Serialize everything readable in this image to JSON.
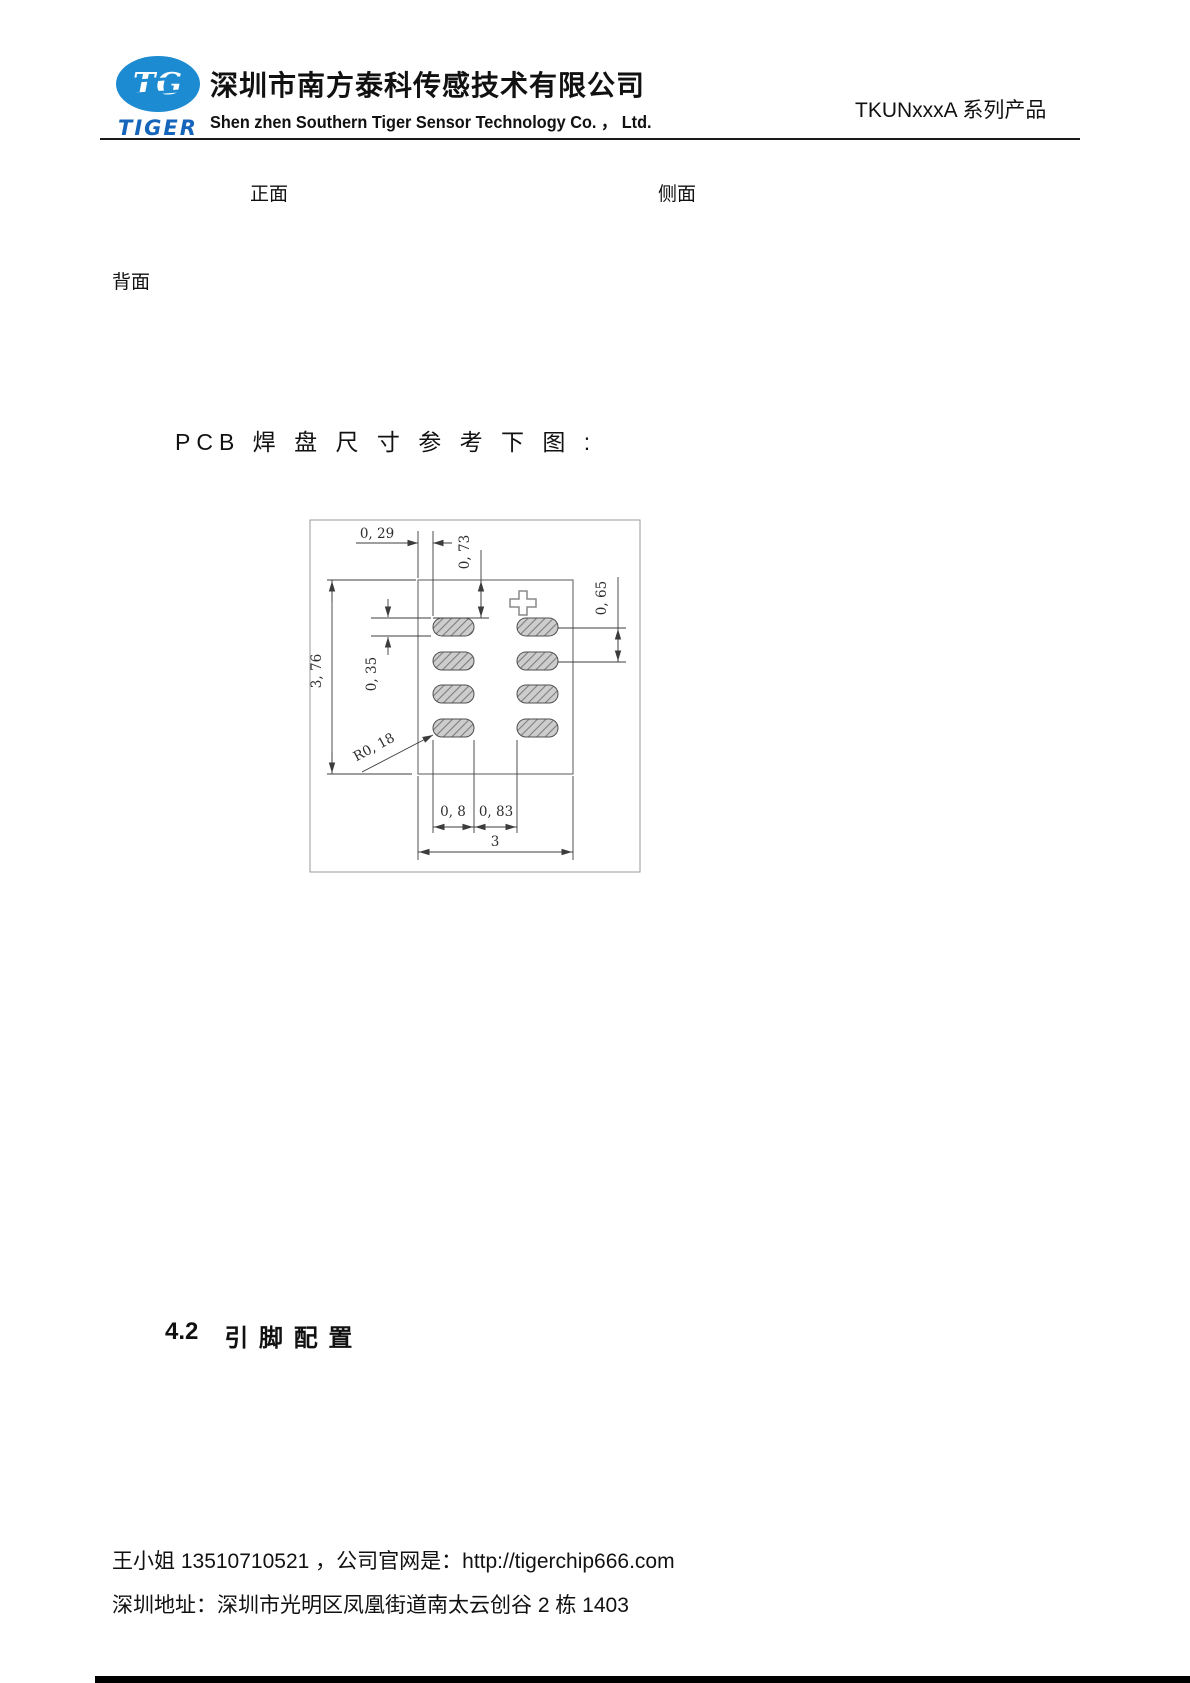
{
  "header": {
    "logo_monogram": "TG",
    "logo_word": "TIGER",
    "logo_color": "#1d8bd1",
    "company_cn": "深圳市南方泰科传感技术有限公司",
    "company_en": "Shen zhen Southern Tiger Sensor Technology Co. ， Ltd.",
    "product_series": "TKUNxxxA 系列产品"
  },
  "labels": {
    "front": "正面",
    "side": "侧面",
    "back": "背面"
  },
  "caption": {
    "pcb": "PCB 焊 盘 尺 寸 参 考 下 图 :"
  },
  "drawing": {
    "d029": "0, 29",
    "d073": "0, 73",
    "d376": "3, 76",
    "d035": "0, 35",
    "d065": "0, 65",
    "r018": "R0, 18",
    "d08": "0, 8",
    "d083": "0, 83",
    "d3": "3"
  },
  "section": {
    "number": "4.2",
    "title": "引 脚 配 置"
  },
  "footer": {
    "line1": "王小姐 13510710521 ，公司官网是：http://tigerchip666.com",
    "line2": "深圳地址：深圳市光明区凤凰街道南太云创谷 2 栋 1403"
  }
}
